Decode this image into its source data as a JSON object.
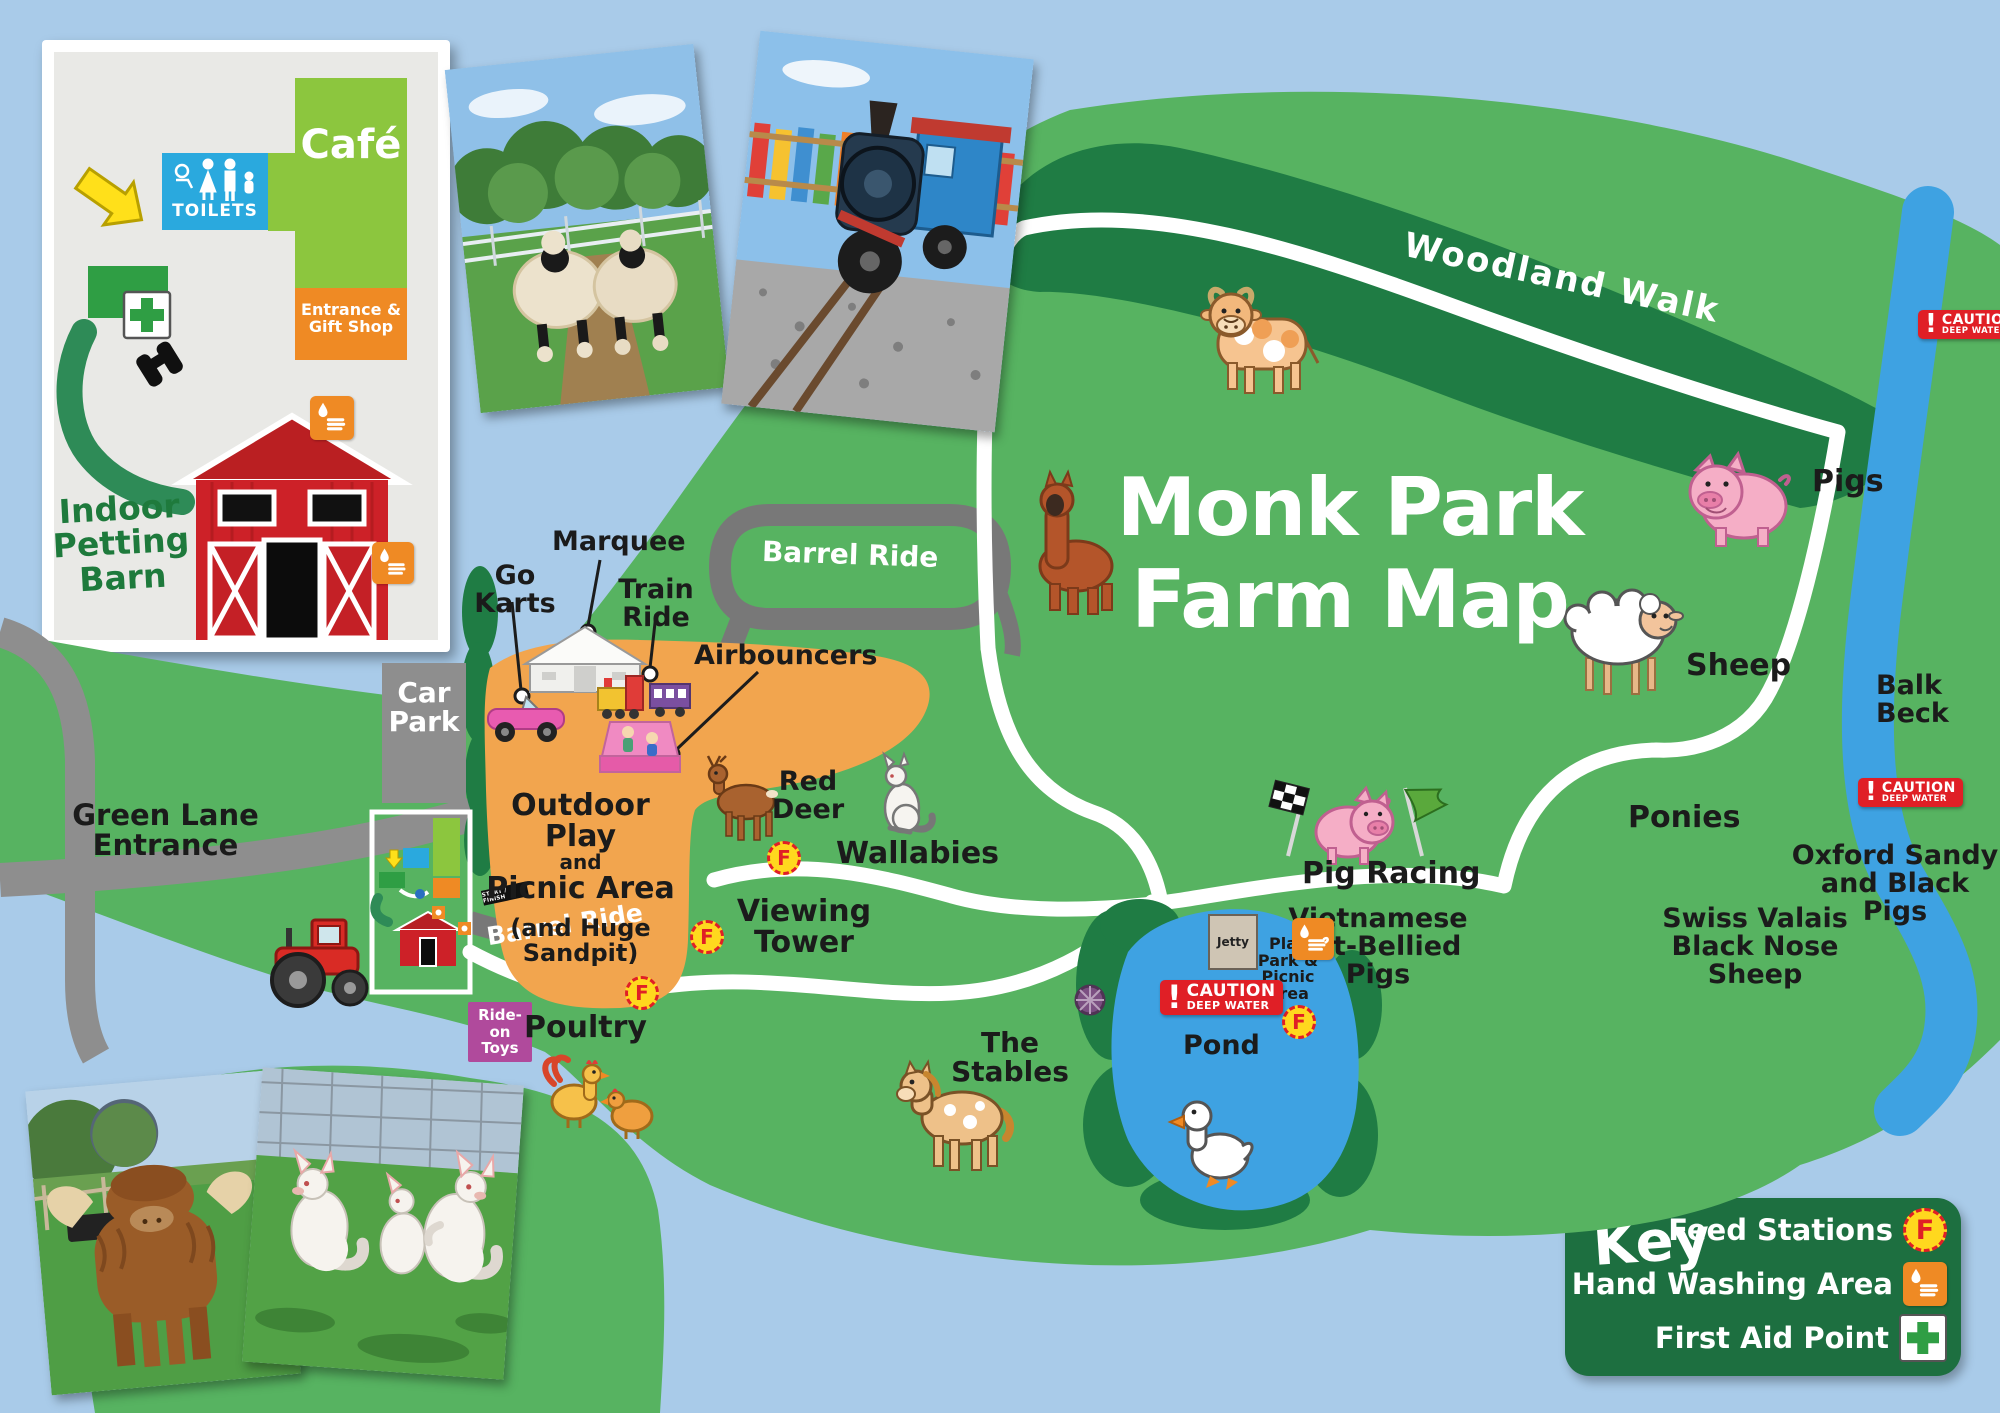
{
  "title": [
    "Monk Park",
    "Farm Map"
  ],
  "inset": {
    "cafe": "Café",
    "toilets": "TOILETS",
    "entrance": [
      "Entrance &",
      "Gift Shop"
    ],
    "petting": [
      "Indoor",
      "Petting",
      "Barn"
    ]
  },
  "labels": {
    "woodland_walk": "Woodland Walk",
    "pigs": "Pigs",
    "sheep": "Sheep",
    "balk_beck": [
      "Balk",
      "Beck"
    ],
    "ponies": "Ponies",
    "oxford": [
      "Oxford Sandy",
      "and Black Pigs"
    ],
    "swiss": [
      "Swiss Valais",
      "Black Nose",
      "Sheep"
    ],
    "vietnamese": [
      "Vietnamese",
      "Pot-Bellied",
      "Pigs"
    ],
    "pig_racing": "Pig Racing",
    "wallabies": "Wallabies",
    "red_deer": [
      "Red",
      "Deer"
    ],
    "viewing_tower": [
      "Viewing",
      "Tower"
    ],
    "marquee": "Marquee",
    "go_karts": [
      "Go",
      "Karts"
    ],
    "train_ride": [
      "Train",
      "Ride"
    ],
    "airbouncers": "Airbouncers",
    "barrel_ride": "Barrel Ride",
    "outdoor_play": [
      "Outdoor Play",
      "and",
      "Picnic Area",
      "(and Huge",
      "Sandpit)"
    ],
    "car_park": [
      "Car",
      "Park"
    ],
    "green_lane": [
      "Green Lane",
      "Entrance"
    ],
    "ride_on_toys": [
      "Ride-on",
      "Toys"
    ],
    "poultry": "Poultry",
    "stables": [
      "The",
      "Stables"
    ],
    "pond": "Pond",
    "jetty": "Jetty",
    "play_park": [
      "Play",
      "Park &",
      "Picnic",
      "Area"
    ],
    "start_finish": "START / FINISH",
    "caution": [
      "CAUTION",
      "DEEP WATER"
    ]
  },
  "key": {
    "title": "Key",
    "feed_letter": "F",
    "items": [
      {
        "label": "Feed Stations",
        "icon": "feed-station-icon"
      },
      {
        "label": "Hand Washing Area",
        "icon": "hand-washing-icon"
      },
      {
        "label": "First Aid Point",
        "icon": "first-aid-icon"
      }
    ]
  },
  "colors": {
    "water": "#a9cbe9",
    "land": "#57b361",
    "woodland": "#1f7c44",
    "beck": "#3ea2e2",
    "play_area": "#f2a54e",
    "road": "#8e8e8e",
    "barrel_track": "#787878",
    "path": "#ffffff",
    "caution_red": "#e01f26",
    "key_green": "#1d6f40",
    "feed_yellow": "#ffd81e",
    "handwash_orange": "#ef8a24",
    "first_aid_green": "#2f9e44",
    "cafe_green": "#8cc63e",
    "toilets_blue": "#2aa9de",
    "barn_red": "#cd2128",
    "ride_on_pink": "#b04a9c",
    "pond_blue": "#3ea2e2"
  }
}
